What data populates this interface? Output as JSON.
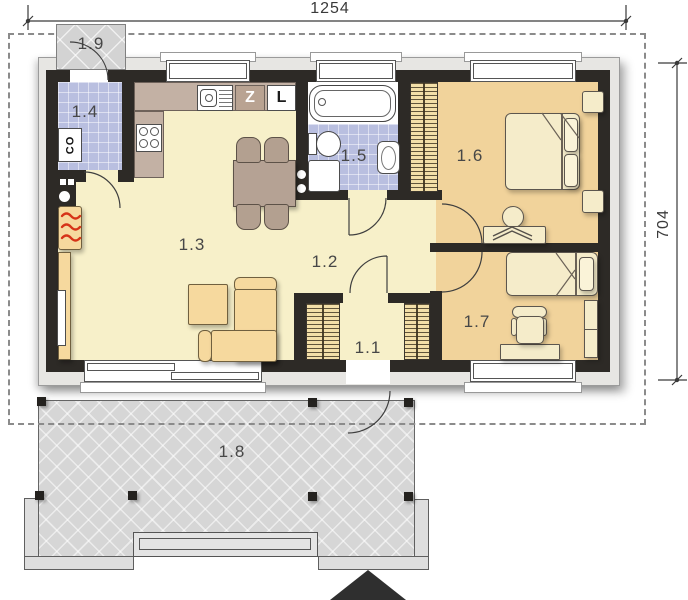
{
  "dimensions": {
    "width_cm": "1254",
    "height_cm": "704"
  },
  "rooms": {
    "r11": {
      "label": "1.1"
    },
    "r12": {
      "label": "1.2"
    },
    "r13": {
      "label": "1.3"
    },
    "r14": {
      "label": "1.4"
    },
    "r15": {
      "label": "1.5"
    },
    "r16": {
      "label": "1.6"
    },
    "r17": {
      "label": "1.7"
    },
    "r18": {
      "label": "1.8"
    },
    "r19": {
      "label": "1.9"
    }
  },
  "markers": {
    "boiler": "CO",
    "kitchen_z": "Z",
    "kitchen_l": "L"
  },
  "colors": {
    "wall": "#2d2a26",
    "band": "#e7e6e3",
    "floor_main": "#f7f0c9",
    "floor_bedroom": "#f1d39b",
    "tile": "#b9bfe0",
    "counter": "#c3b1a4",
    "furniture": "#f6d99e",
    "terrace": "#d6d6d6",
    "accent_red": "#d63317"
  }
}
